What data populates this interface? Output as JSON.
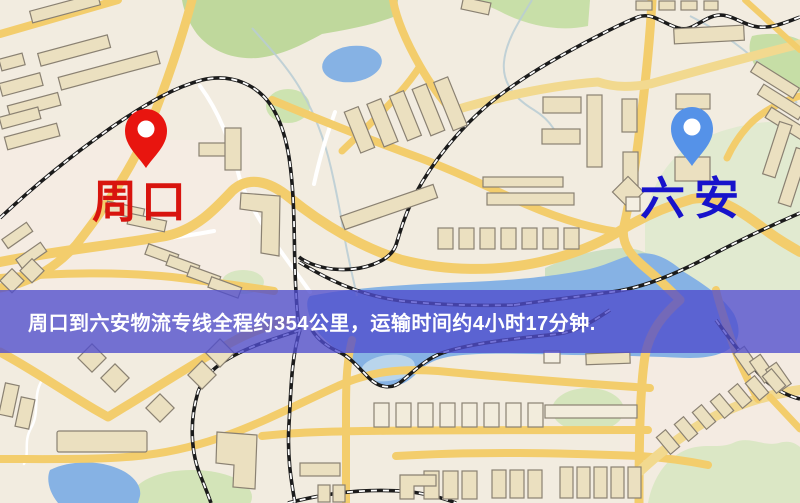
{
  "map": {
    "origin": {
      "label": "周口"
    },
    "destination": {
      "label": "六安"
    },
    "banner": {
      "text": "周口到六安物流专线全程约354公里，运输时间约4小时17分钟.",
      "distance_text": "约354公里",
      "duration_text": "约4小时17分钟"
    }
  },
  "colors": {
    "background": "#f2ece0",
    "road": "#f3cd6c",
    "road_pale": "#f2d98f",
    "road_white": "#ffffff",
    "railway": "#1b1b1b",
    "railway_dash": "#ffffff",
    "water": "#86b2e4",
    "stream": "#b9cdd4",
    "park": "#bfd89c",
    "building_fill": "#ebe0c0",
    "building_stroke": "#8a8172",
    "origin_pin": "#e8150f",
    "origin_label": "#d8140e",
    "destination_pin": "#5592e8",
    "destination_label": "#1713cb",
    "banner_bg": "rgba(79,77,205,0.78)",
    "banner_text": "#ffffff"
  }
}
